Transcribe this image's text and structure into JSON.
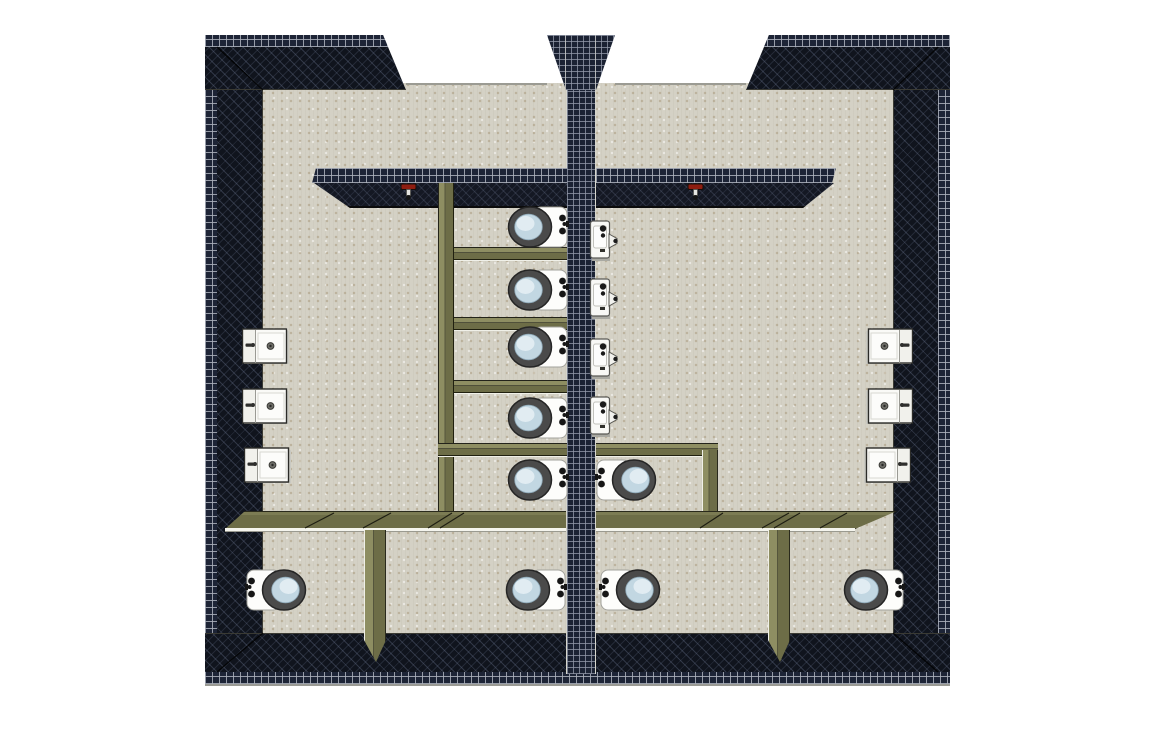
{
  "scene": {
    "title": "3D top-down view of a mirrored public restroom floor plan",
    "canvas": {
      "width": 1152,
      "height": 748
    },
    "colors": {
      "background": "#ffffff",
      "floor": "#d4d1c5",
      "wall_tile": "#1d2436",
      "wall_grout": "#aab1bc",
      "wall_inner_face": "#10141d",
      "partition_olive": "#6d6d47",
      "partition_light": "#8e8e62",
      "porcelain": "#fbfbf8",
      "toilet_seat": "#4a4a4a",
      "water_blue": "#c2d7e2",
      "valve_red": "#8f1d10"
    }
  },
  "rooms": {
    "left": {
      "label": "left-restroom",
      "toilet_count": 7,
      "urinal_count": 0,
      "sink_count": 3
    },
    "right": {
      "label": "right-restroom",
      "toilet_count": 3,
      "urinal_count": 4,
      "sink_count": 3
    }
  },
  "fixtures": {
    "toilets": [
      {
        "x": 506,
        "y": 204,
        "facing": "w"
      },
      {
        "x": 506,
        "y": 267,
        "facing": "w"
      },
      {
        "x": 506,
        "y": 324,
        "facing": "w"
      },
      {
        "x": 506,
        "y": 395,
        "facing": "w"
      },
      {
        "x": 506,
        "y": 457,
        "facing": "w"
      },
      {
        "x": 594,
        "y": 457,
        "facing": "e"
      },
      {
        "x": 244,
        "y": 567,
        "facing": "e"
      },
      {
        "x": 504,
        "y": 567,
        "facing": "w"
      },
      {
        "x": 598,
        "y": 567,
        "facing": "e"
      },
      {
        "x": 842,
        "y": 567,
        "facing": "w"
      }
    ],
    "urinals": [
      {
        "x": 589,
        "y": 219
      },
      {
        "x": 589,
        "y": 277
      },
      {
        "x": 589,
        "y": 337
      },
      {
        "x": 589,
        "y": 395
      }
    ],
    "sinks": [
      {
        "x": 242,
        "y": 328,
        "side": "left"
      },
      {
        "x": 242,
        "y": 388,
        "side": "left"
      },
      {
        "x": 244,
        "y": 447,
        "side": "left"
      },
      {
        "x": 866,
        "y": 328,
        "side": "right"
      },
      {
        "x": 866,
        "y": 388,
        "side": "right"
      },
      {
        "x": 864,
        "y": 447,
        "side": "right"
      }
    ],
    "flush_valves": [
      {
        "x": 400,
        "y": 181
      },
      {
        "x": 687,
        "y": 181
      }
    ]
  },
  "partitions": [
    {
      "kind": "part-v",
      "x": 438,
      "y": 183,
      "w": 16,
      "h": 347
    },
    {
      "kind": "part-h",
      "x": 454,
      "y": 247,
      "w": 113,
      "h": 14
    },
    {
      "kind": "part-h",
      "x": 454,
      "y": 317,
      "w": 113,
      "h": 14
    },
    {
      "kind": "part-h",
      "x": 454,
      "y": 380,
      "w": 113,
      "h": 14
    },
    {
      "kind": "part-h",
      "x": 438,
      "y": 443,
      "w": 129,
      "h": 14
    },
    {
      "kind": "part-h",
      "x": 596,
      "y": 443,
      "w": 122,
      "h": 14
    },
    {
      "kind": "part-vw",
      "x": 702,
      "y": 450,
      "w": 16,
      "h": 80
    },
    {
      "kind": "part-long",
      "x": 225,
      "y": 511,
      "w": 341,
      "h": 18,
      "clip": "20px 0,341px 0,341px 18px,0 18px"
    },
    {
      "kind": "part-long",
      "x": 596,
      "y": 511,
      "w": 301,
      "h": 18,
      "clip": "0 0,301px 0,259px 18px,0 18px"
    },
    {
      "kind": "part-strip",
      "x": 225,
      "y": 528,
      "w": 341,
      "h": 4
    },
    {
      "kind": "part-strip",
      "x": 596,
      "y": 528,
      "w": 259,
      "h": 4
    },
    {
      "kind": "part-vw",
      "x": 364,
      "y": 530,
      "w": 22,
      "h": 132,
      "clip": "0 0,22px 0,22px 110px,12px 132px,0 110px"
    },
    {
      "kind": "part-vw",
      "x": 768,
      "y": 530,
      "w": 22,
      "h": 132,
      "clip": "0 0,22px 0,22px 110px,12px 132px,0 110px"
    }
  ],
  "door_seams": [
    {
      "x1": 305,
      "y1": 528,
      "x2": 334,
      "y2": 513
    },
    {
      "x1": 363,
      "y1": 528,
      "x2": 391,
      "y2": 513
    },
    {
      "x1": 428,
      "y1": 528,
      "x2": 452,
      "y2": 513
    },
    {
      "x1": 440,
      "y1": 528,
      "x2": 464,
      "y2": 513
    },
    {
      "x1": 700,
      "y1": 528,
      "x2": 723,
      "y2": 513
    },
    {
      "x1": 762,
      "y1": 528,
      "x2": 789,
      "y2": 513
    },
    {
      "x1": 774,
      "y1": 528,
      "x2": 800,
      "y2": 513
    },
    {
      "x1": 820,
      "y1": 528,
      "x2": 847,
      "y2": 513
    }
  ]
}
